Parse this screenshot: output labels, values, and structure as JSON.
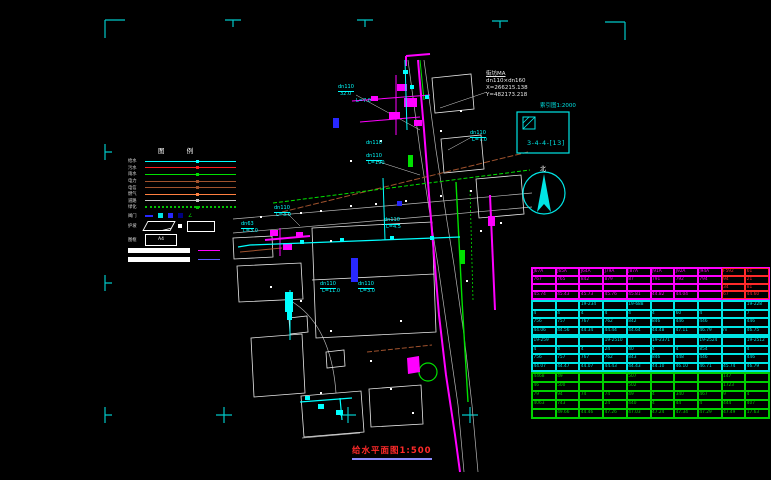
{
  "colors": {
    "bg": "#000000",
    "cyan": "#00ffff",
    "magenta": "#ff00ff",
    "green": "#00e000",
    "red": "#ff2a2a",
    "white": "#e8e8e8",
    "maroon": "#a0522d",
    "orange": "#ff8040",
    "blue": "#2828ff",
    "tick": "#00c8c8"
  },
  "sheet_title": {
    "text": "给水平面图1:500"
  },
  "callout": {
    "lines": [
      "街坊MA",
      "dn110×dn160",
      "X=266215.138",
      "Y=482173.218"
    ],
    "index_label": "索引图1:2000",
    "detail_ref": "3-4-4-[13]"
  },
  "north": {
    "label": "北"
  },
  "legend": {
    "title": "图 例",
    "lines": [
      {
        "label": "给水",
        "color": "#00ffff",
        "style": "solid"
      },
      {
        "label": "污水",
        "color": "#ff2020",
        "style": "solid"
      },
      {
        "label": "雨水",
        "color": "#00e000",
        "style": "solid"
      },
      {
        "label": "电力",
        "color": "#a0522d",
        "style": "solid"
      },
      {
        "label": "电信",
        "color": "#a0522d",
        "style": "solid"
      },
      {
        "label": "燃气",
        "color": "#ff8040",
        "style": "solid"
      },
      {
        "label": "道路",
        "color": "#c8c8c8",
        "style": "solid"
      },
      {
        "label": "绿化",
        "color": "#00c000",
        "style": "dotted"
      }
    ],
    "valve_label": "阀门",
    "slope_label": "护坡",
    "frame_label": "图框",
    "a4_text": "A4",
    "bar1_label": "规划道路",
    "plan_water_color": "#ff00ff",
    "plan_drain_color": "#5858ff"
  },
  "map": {
    "labels": [
      {
        "t": "dn110",
        "x": 338,
        "y": 85,
        "u": true
      },
      {
        "t": "32.0",
        "x": 340,
        "y": 92
      },
      {
        "t": "L=7.0",
        "x": 356,
        "y": 99
      },
      {
        "t": "dn110",
        "x": 366,
        "y": 154,
        "u": true
      },
      {
        "t": "L=190",
        "x": 368,
        "y": 161
      },
      {
        "t": "dn110",
        "x": 470,
        "y": 131,
        "u": true
      },
      {
        "t": "L=7.0",
        "x": 472,
        "y": 138
      },
      {
        "t": "dn110",
        "x": 274,
        "y": 206,
        "u": true
      },
      {
        "t": "L=3.0",
        "x": 276,
        "y": 213
      },
      {
        "t": "dn63",
        "x": 241,
        "y": 222,
        "u": true
      },
      {
        "t": "L=3.0",
        "x": 243,
        "y": 229
      },
      {
        "t": "dn110",
        "x": 384,
        "y": 218,
        "u": true
      },
      {
        "t": "L=4.5",
        "x": 386,
        "y": 225
      },
      {
        "t": "dn110",
        "x": 320,
        "y": 282,
        "u": true
      },
      {
        "t": "L=11.0",
        "x": 322,
        "y": 289
      },
      {
        "t": "dn110",
        "x": 358,
        "y": 282,
        "u": true
      },
      {
        "t": "L=3.0",
        "x": 360,
        "y": 289
      },
      {
        "t": "dn110",
        "x": 366,
        "y": 141,
        "u": false
      }
    ]
  },
  "table": {
    "sections": [
      {
        "text_color": "#ff00ff",
        "border_color": "#ff00ff",
        "red_cols": [
          8,
          9
        ],
        "red_color": "#ff2a2a",
        "height": 33,
        "rows": [
          [
            "J67A",
            "J65A",
            "J64A",
            "J79A",
            "J87A",
            "J91A",
            "J92A",
            "J94A",
            "F592",
            "61"
          ],
          [
            "767",
            "765",
            "842",
            "879",
            "87",
            "791",
            "792",
            "794",
            "94",
            "21"
          ],
          [
            "",
            "",
            "",
            "",
            "",
            "",
            "",
            "",
            "34",
            "81"
          ],
          [
            "45.74",
            "45.43",
            "45.73",
            "45.76",
            "45.81",
            "44.82",
            "44.04",
            "",
            "67",
            "44.60"
          ]
        ]
      },
      {
        "text_color": "#00e5e5",
        "border_color": "#00e5e5",
        "height": 36,
        "rows": [
          [
            "",
            "",
            "19-234",
            "",
            "19-688",
            "",
            "",
            "",
            "",
            "19-228"
          ],
          [
            "4",
            "4",
            "4",
            "4",
            "4",
            "4",
            "60",
            "4",
            "",
            "7"
          ],
          [
            "756",
            "757",
            "767",
            "762",
            "842",
            "846",
            "446",
            "446",
            "",
            "446"
          ],
          [
            "44.06",
            "44.56",
            "44.34",
            "44.44",
            "44.64",
            "44.48",
            "47.11",
            "46.79",
            "m",
            "46.75"
          ]
        ]
      },
      {
        "text_color": "#00e5e5",
        "border_color": "#00e5e5",
        "height": 36,
        "rows": [
          [
            "19-259",
            "",
            "",
            "19-2510",
            "",
            "19-2371",
            "",
            "19-2524",
            "",
            "19-2512"
          ],
          [
            "4",
            "4",
            "4",
            "24",
            "40",
            "4",
            "4",
            "854",
            "",
            "4"
          ],
          [
            "756",
            "757",
            "767",
            "762",
            "843",
            "846",
            "448",
            "446",
            "",
            "446"
          ],
          [
            "44.07",
            "44.47",
            "44.07",
            "44.43",
            "44.43",
            "44.10",
            "46.10",
            "46.71",
            "45.74",
            "46.79"
          ]
        ]
      },
      {
        "text_color": "#00d000",
        "border_color": "#00d000",
        "height": 47,
        "rows": [
          [
            "4468",
            "49",
            "",
            "",
            "507",
            "",
            "",
            "",
            "147",
            ""
          ],
          [
            "46",
            "500",
            "",
            "",
            "502",
            "",
            "",
            "",
            "1723",
            ""
          ],
          [
            "79",
            "94",
            "74",
            "74",
            "49",
            "4",
            "340",
            "467",
            "9",
            "4"
          ],
          [
            "4063",
            "743",
            "",
            "24",
            "440",
            "4",
            "44",
            "4",
            "444",
            "407"
          ],
          [
            "",
            "49.66",
            "44.46",
            "47.26",
            "47.03",
            "47.24",
            "47.34",
            "47.29",
            "47.49",
            "17.63"
          ]
        ]
      }
    ]
  }
}
